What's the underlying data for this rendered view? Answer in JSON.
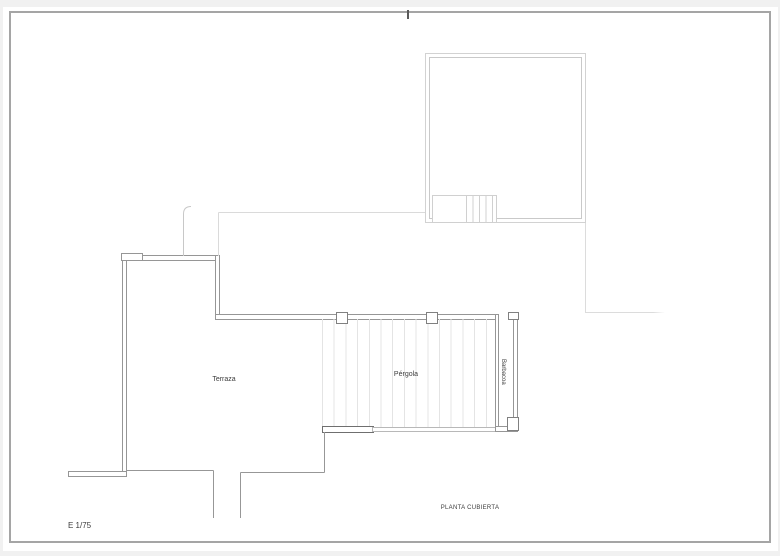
{
  "sheet": {
    "plan_title": "PLANTA CUBIERTA",
    "scale_label": "E 1/75"
  },
  "rooms": {
    "terraza": {
      "label": "Terraza"
    },
    "pergola": {
      "label": "Pérgola"
    },
    "barbacoa": {
      "label": "Barbacoa"
    }
  },
  "colors": {
    "frame_border": "#a5a5a5",
    "wall_line": "#969696",
    "roof_line": "#d2d2d2",
    "faint_line": "#d9d9d9",
    "stripe": "#e4e4e4",
    "text": "#3c3c3c",
    "page_margin": "#f1f1f1"
  }
}
